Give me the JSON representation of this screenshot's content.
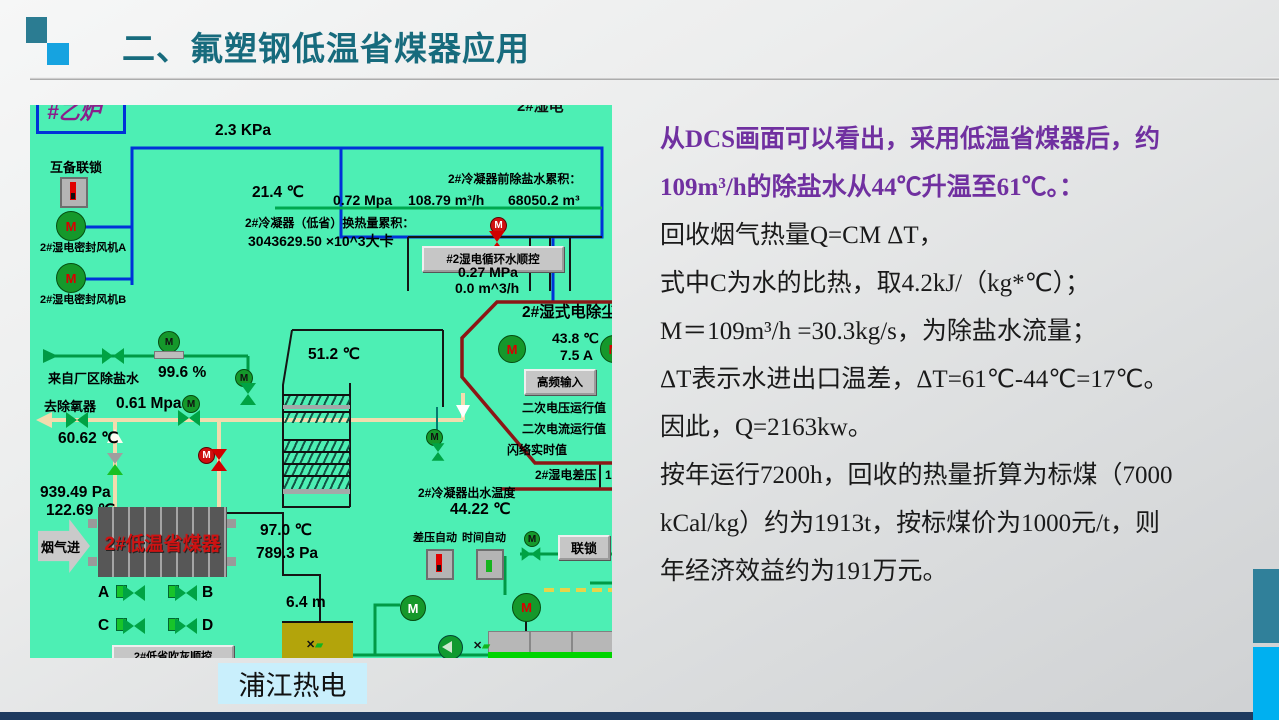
{
  "slide": {
    "title": "二、氟塑钢低温省煤器应用",
    "caption": "浦江热电"
  },
  "analysis": {
    "highlight": [
      "从DCS画面可以看出，采用低温省煤器后，约",
      "109m³/h的除盐水从44℃升温至61℃。："
    ],
    "lines": [
      "回收烟气热量Q=CM ΔT，",
      "式中C为水的比热，取4.2kJ/（kg*℃）；",
      "M＝109m³/h =30.3kg/s，为除盐水流量；",
      "ΔT表示水进出口温差，ΔT=61℃-44℃=17℃。",
      "因此，Q=2163kw。",
      "按年运行7200h，回收的热量折算为标煤（7000",
      "kCal/kg）约为1913t，按标煤价为1000元/t，则",
      "年经济效益约为191万元。"
    ]
  },
  "colors": {
    "title_teal": "#176b7d",
    "highlight_purple": "#7030A0",
    "dcs_background": "#4DEFB4",
    "accent_teal": "#30809a",
    "accent_blue": "#00b0f0",
    "bottom_bar": "#1e3a5f",
    "caption_bg": "#c9effc",
    "eco_text_red": "#cf1212"
  },
  "dcs": {
    "boiler_tag": "#乙炉",
    "top_partial": "2#湿电",
    "pressure_top": "2.3 KPa",
    "interlock_label": "互备联锁",
    "fan_a": "2#湿电密封风机A",
    "fan_b": "2#湿电密封风机B",
    "temp_214": "21.4 ℃",
    "mpa_072": "0.72 Mpa",
    "flow_10879": "108.79 m³/h",
    "accum_title": "2#冷凝器前除盐水累积：",
    "accum_value": "68050.2 m³",
    "heat_title": "2#冷凝器（低省）换热量累积：",
    "heat_value": "3043629.50 ×10^3大卡",
    "seq_button": "#2湿电循环水顺控",
    "mpa_027": "0.27 MPa",
    "flow_00": "0.0 m^3/h",
    "temp_512": "51.2 ℃",
    "esp_title": "2#湿式电除尘",
    "temp_438": "43.8 ℃",
    "amp_75": "7.5 A",
    "hf_button": "高频输入",
    "sec_voltage": "二次电压运行值",
    "sec_current": "二次电流运行值",
    "flashover": "闪络实时值",
    "esp_dp": "2#湿电差压",
    "esp_dp_value": "1",
    "from_plant": "来自厂区除盐水",
    "percent": "99.6 %",
    "to_deaerator": "去除氧器",
    "mpa_061": "0.61 Mpa",
    "temp_6062": "60.62 ℃",
    "pa_939": "939.49 Pa",
    "temp_12269": "122.69 ℃",
    "flue_in": "烟气进",
    "eco_name": "2#低温省煤器",
    "valve_a": "A",
    "valve_b": "B",
    "valve_c": "C",
    "valve_d": "D",
    "temp_970": "97.0 ℃",
    "pa_789": "789.3 Pa",
    "outlet_title": "2#冷凝器出水温度",
    "temp_4422": "44.22 ℃",
    "level_64": "6.4 m",
    "dp_auto": "差压自动",
    "time_auto": "时间自动",
    "interlock_button": "联锁",
    "purge_button": "2#低省吹灰顺控",
    "icons": {
      "motor_letter": "M"
    }
  }
}
